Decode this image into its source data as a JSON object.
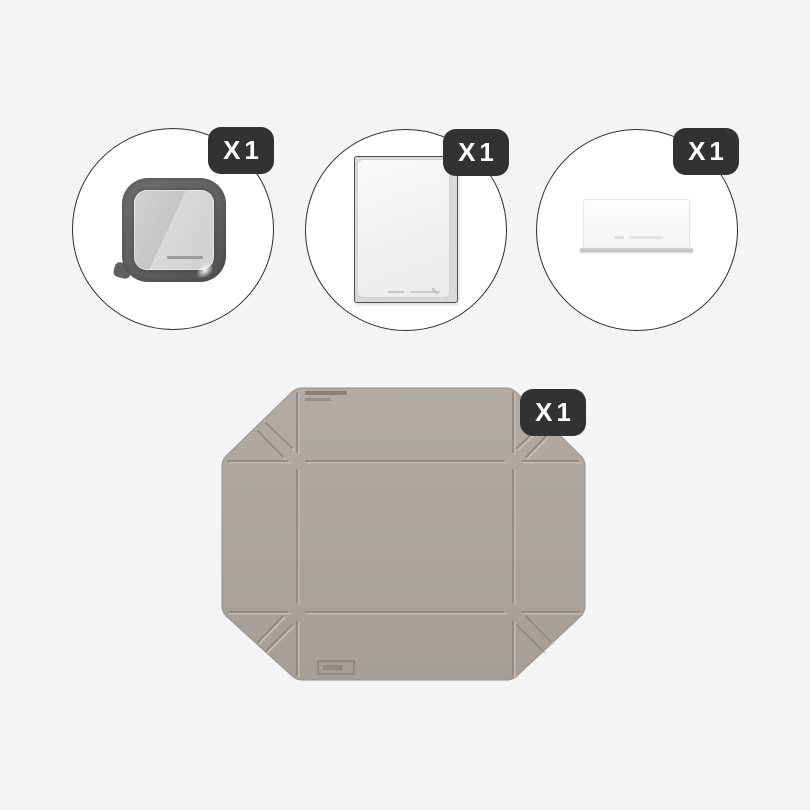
{
  "page": {
    "background": "#f4f4f4"
  },
  "components": [
    {
      "id": "container-base-with-lid",
      "quantity_label": "X1"
    },
    {
      "id": "flat-clear-lid",
      "quantity_label": "X1"
    },
    {
      "id": "divider-plate",
      "quantity_label": "X1"
    },
    {
      "id": "folding-silicone-mat",
      "quantity_label": "X1"
    }
  ],
  "colors": {
    "badge_bg": "#323232",
    "badge_text": "#ffffff",
    "circle_stroke": "#2d2d2d",
    "circle_fill": "#ffffff",
    "container_frame": "#656565",
    "container_lid": "#c7c7c7",
    "mat_top": "#b1aba4",
    "mat_bottom": "#a49e97",
    "mat_groove": "#8e8880",
    "mat_groove_highlight": "#c3bdb6"
  }
}
